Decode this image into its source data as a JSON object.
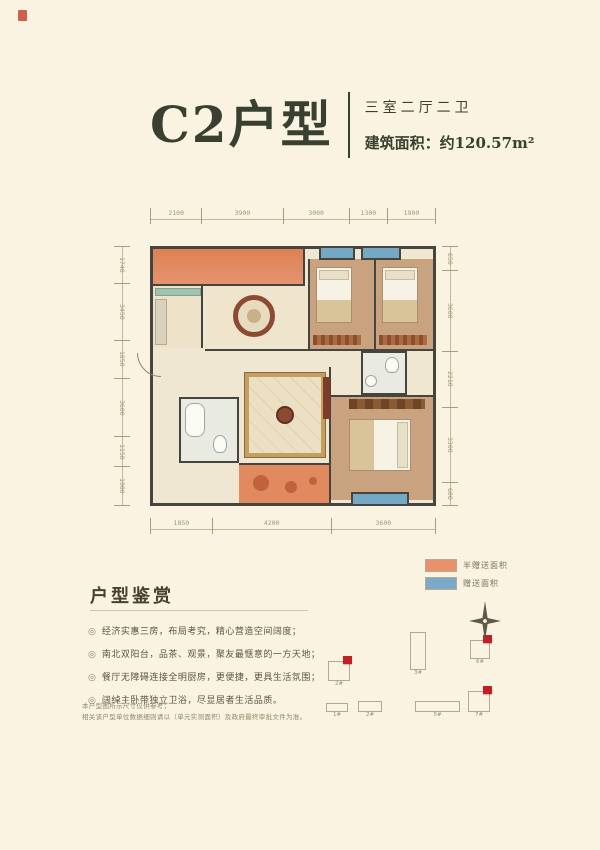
{
  "header": {
    "title": "C2户型",
    "type_label": "三室二厅二卫",
    "area_label": "建筑面积：约120.57m²"
  },
  "floorplan": {
    "dims_top": [
      2100,
      3900,
      3000,
      1300,
      1900
    ],
    "dims_left": [
      1740,
      3450,
      1850,
      3600,
      1150,
      1900
    ],
    "dims_right": [
      650,
      3600,
      2210,
      3300,
      600
    ],
    "dims_bottom": [
      1850,
      4200,
      3600
    ]
  },
  "legend": {
    "items": [
      {
        "label": "半赠送面积",
        "color": "#e8916b"
      },
      {
        "label": "赠送面积",
        "color": "#7aa9c9"
      }
    ]
  },
  "section": {
    "title": "户型鉴赏",
    "bullet_glyph": "◎",
    "bullets": [
      "经济实惠三房，布局考究，精心营造空间阔度；",
      "南北双阳台，品茶、观景，聚友最惬意的一方天地；",
      "餐厅无障碍连接全明厨房，更便捷，更具生活氛围；",
      "阔绰主卧带独立卫浴，尽显居者生活品质。"
    ]
  },
  "disclaimer": {
    "lines": [
      "本户型图所示尺寸仅供参考；",
      "相关该户型单位数据细则请以（单元实测面积）及政府最终审批文件为准。"
    ]
  },
  "siteplan": {
    "marker_color": "#c21f24",
    "buildings": [
      {
        "label": "2#",
        "x": 28,
        "y": 63,
        "w": 22,
        "h": 20,
        "marker": true
      },
      {
        "label": "3#",
        "x": 110,
        "y": 34,
        "w": 16,
        "h": 38,
        "marker": false
      },
      {
        "label": "6#",
        "x": 170,
        "y": 42,
        "w": 20,
        "h": 19,
        "marker": true
      },
      {
        "label": "1#",
        "x": 26,
        "y": 105,
        "w": 22,
        "h": 9,
        "marker": false
      },
      {
        "label": "2#",
        "x": 58,
        "y": 103,
        "w": 24,
        "h": 11,
        "marker": false
      },
      {
        "label": "5#",
        "x": 115,
        "y": 103,
        "w": 45,
        "h": 11,
        "marker": false
      },
      {
        "label": "7#",
        "x": 168,
        "y": 93,
        "w": 22,
        "h": 21,
        "marker": true
      }
    ]
  }
}
